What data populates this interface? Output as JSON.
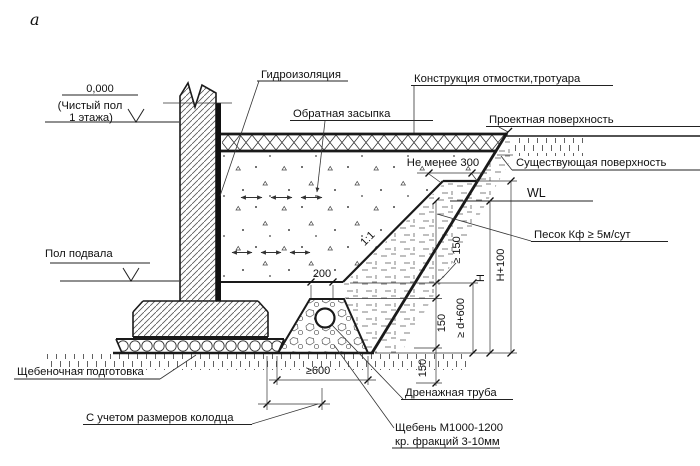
{
  "figure": {
    "index_label": "а"
  },
  "levels": {
    "zero": "0,000",
    "zero_note1": "(Чистый пол",
    "zero_note2": "1 этажа)",
    "basement_floor": "Пол подвала"
  },
  "callouts": {
    "waterproofing": "Гидроизоляция",
    "backfill": "Обратная засыпка",
    "pavement": "Конструкция отмостки,тротуара",
    "design_surface": "Проектная поверхность",
    "existing_surface": "Существующая поверхность",
    "water_level": "WL",
    "sand_spec": "Песок Кф ≥ 5м/сут",
    "rubble_prep": "Щебеночная подготовка",
    "drain_pipe": "Дренажная труба",
    "gravel_spec_line1": "Щебень М1000-1200",
    "gravel_spec_line2": "кр. фракций 3-10мм",
    "well_note": "С учетом размеров колодца"
  },
  "dims": {
    "min300": "Не менее 300",
    "w200": "200",
    "slope_ratio": "1:1",
    "ge150": "≥ 150",
    "t150": "150",
    "ge_d600": "≥ d+600",
    "H": "H",
    "H100": "H+100",
    "b150": "150",
    "ge600": "≥600"
  },
  "colors": {
    "ink": "#1a1a1a",
    "paper": "#ffffff"
  }
}
